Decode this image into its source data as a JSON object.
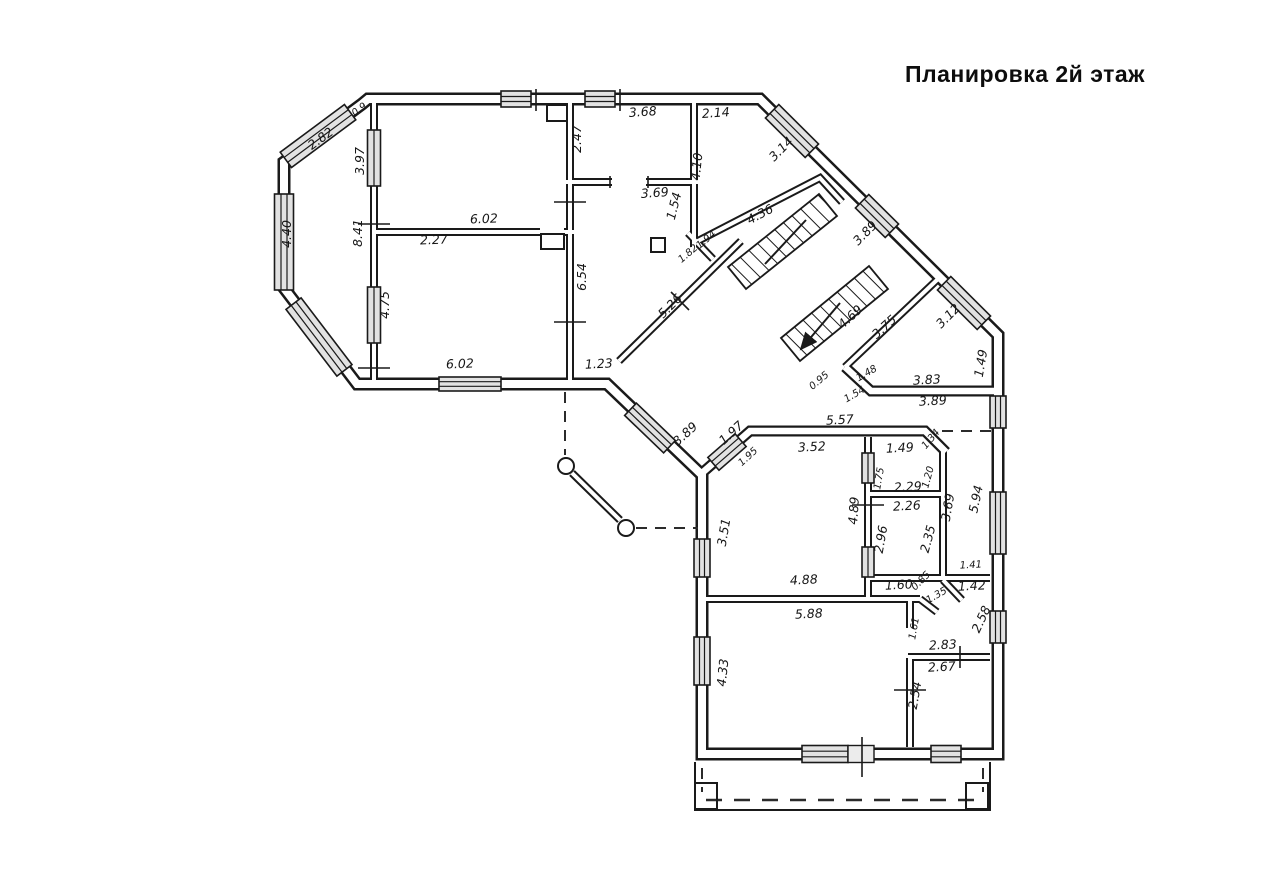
{
  "title": "Планировка 2й этаж",
  "floorplan": {
    "colors": {
      "line": "#1a1a1a",
      "paper": "#ffffff",
      "window_fill": "#e2e2e2"
    },
    "labels": [
      {
        "t": "2.82",
        "x": 323,
        "y": 142,
        "r": -36
      },
      {
        "t": "0.9",
        "x": 361,
        "y": 112,
        "r": -36,
        "s": 1
      },
      {
        "t": "3.97",
        "x": 364,
        "y": 161,
        "r": -90
      },
      {
        "t": "8.41",
        "x": 362,
        "y": 233,
        "r": -90
      },
      {
        "t": "4.40",
        "x": 291,
        "y": 234,
        "r": -90
      },
      {
        "t": "4.75",
        "x": 389,
        "y": 305,
        "r": -90
      },
      {
        "t": "6.02",
        "x": 484,
        "y": 223,
        "r": -2
      },
      {
        "t": "2.27",
        "x": 434,
        "y": 244,
        "r": -2
      },
      {
        "t": "6.02",
        "x": 460,
        "y": 368,
        "r": -2
      },
      {
        "t": "6.54",
        "x": 586,
        "y": 277,
        "r": -90
      },
      {
        "t": "2.47",
        "x": 581,
        "y": 139,
        "r": -90
      },
      {
        "t": "3.68",
        "x": 643,
        "y": 116,
        "r": -4
      },
      {
        "t": "2.14",
        "x": 716,
        "y": 117,
        "r": -4
      },
      {
        "t": "4.10",
        "x": 701,
        "y": 167,
        "r": -84
      },
      {
        "t": "3.69",
        "x": 655,
        "y": 197,
        "r": -4
      },
      {
        "t": "1.54",
        "x": 678,
        "y": 207,
        "r": -76
      },
      {
        "t": "1.94",
        "x": 708,
        "y": 242,
        "r": -40,
        "s": 1
      },
      {
        "t": "1.82",
        "x": 690,
        "y": 256,
        "r": -40,
        "s": 1
      },
      {
        "t": "4.36",
        "x": 762,
        "y": 218,
        "r": -28
      },
      {
        "t": "3.14",
        "x": 784,
        "y": 152,
        "r": -45
      },
      {
        "t": "3.89",
        "x": 868,
        "y": 236,
        "r": -45
      },
      {
        "t": "3.12",
        "x": 951,
        "y": 319,
        "r": -45
      },
      {
        "t": "1.49",
        "x": 985,
        "y": 364,
        "r": -80
      },
      {
        "t": "4.69",
        "x": 853,
        "y": 320,
        "r": -42
      },
      {
        "t": "3.75",
        "x": 887,
        "y": 330,
        "r": -42
      },
      {
        "t": "0.95",
        "x": 821,
        "y": 383,
        "r": -40,
        "s": 1
      },
      {
        "t": "1.48",
        "x": 868,
        "y": 376,
        "r": -30,
        "s": 1
      },
      {
        "t": "1.54",
        "x": 856,
        "y": 397,
        "r": -30,
        "s": 1
      },
      {
        "t": "3.83",
        "x": 927,
        "y": 384,
        "r": -3
      },
      {
        "t": "3.89",
        "x": 933,
        "y": 405,
        "r": -3
      },
      {
        "t": "5.26",
        "x": 673,
        "y": 309,
        "r": -45
      },
      {
        "t": "1.23",
        "x": 599,
        "y": 368,
        "r": -3
      },
      {
        "t": "3.89",
        "x": 688,
        "y": 437,
        "r": -42
      },
      {
        "t": "1.97",
        "x": 734,
        "y": 436,
        "r": -42
      },
      {
        "t": "1.95",
        "x": 750,
        "y": 459,
        "r": -42,
        "s": 1
      },
      {
        "t": "5.57",
        "x": 840,
        "y": 424,
        "r": -3
      },
      {
        "t": "1.34",
        "x": 933,
        "y": 441,
        "r": -50,
        "s": 1
      },
      {
        "t": "3.52",
        "x": 812,
        "y": 451,
        "r": -3
      },
      {
        "t": "1.49",
        "x": 900,
        "y": 452,
        "r": -3
      },
      {
        "t": "1.75",
        "x": 882,
        "y": 479,
        "r": -80,
        "s": 1
      },
      {
        "t": "2.29",
        "x": 908,
        "y": 491,
        "r": -3
      },
      {
        "t": "1.20",
        "x": 931,
        "y": 478,
        "r": -75,
        "s": 1
      },
      {
        "t": "3.69",
        "x": 952,
        "y": 508,
        "r": -80
      },
      {
        "t": "5.94",
        "x": 980,
        "y": 500,
        "r": -78
      },
      {
        "t": "4.89",
        "x": 858,
        "y": 511,
        "r": -86
      },
      {
        "t": "2.26",
        "x": 907,
        "y": 510,
        "r": -3
      },
      {
        "t": "2.96",
        "x": 885,
        "y": 540,
        "r": -80
      },
      {
        "t": "2.35",
        "x": 932,
        "y": 540,
        "r": -75
      },
      {
        "t": "3.51",
        "x": 728,
        "y": 533,
        "r": -80
      },
      {
        "t": "4.88",
        "x": 804,
        "y": 584,
        "r": -3
      },
      {
        "t": "1.60",
        "x": 899,
        "y": 589,
        "r": -3
      },
      {
        "t": "0.85",
        "x": 923,
        "y": 583,
        "r": -45,
        "s": 1
      },
      {
        "t": "1.35",
        "x": 938,
        "y": 598,
        "r": -30,
        "s": 1
      },
      {
        "t": "1.41",
        "x": 971,
        "y": 568,
        "r": -3,
        "s": 1
      },
      {
        "t": "1.42",
        "x": 972,
        "y": 590,
        "r": -3
      },
      {
        "t": "5.88",
        "x": 809,
        "y": 618,
        "r": -3
      },
      {
        "t": "4.33",
        "x": 727,
        "y": 673,
        "r": -84
      },
      {
        "t": "1.61",
        "x": 917,
        "y": 629,
        "r": -80,
        "s": 1
      },
      {
        "t": "2.58",
        "x": 985,
        "y": 621,
        "r": -65
      },
      {
        "t": "2.83",
        "x": 943,
        "y": 649,
        "r": -3
      },
      {
        "t": "2.67",
        "x": 942,
        "y": 671,
        "r": -3
      },
      {
        "t": "2.54",
        "x": 919,
        "y": 696,
        "r": -80
      }
    ]
  }
}
